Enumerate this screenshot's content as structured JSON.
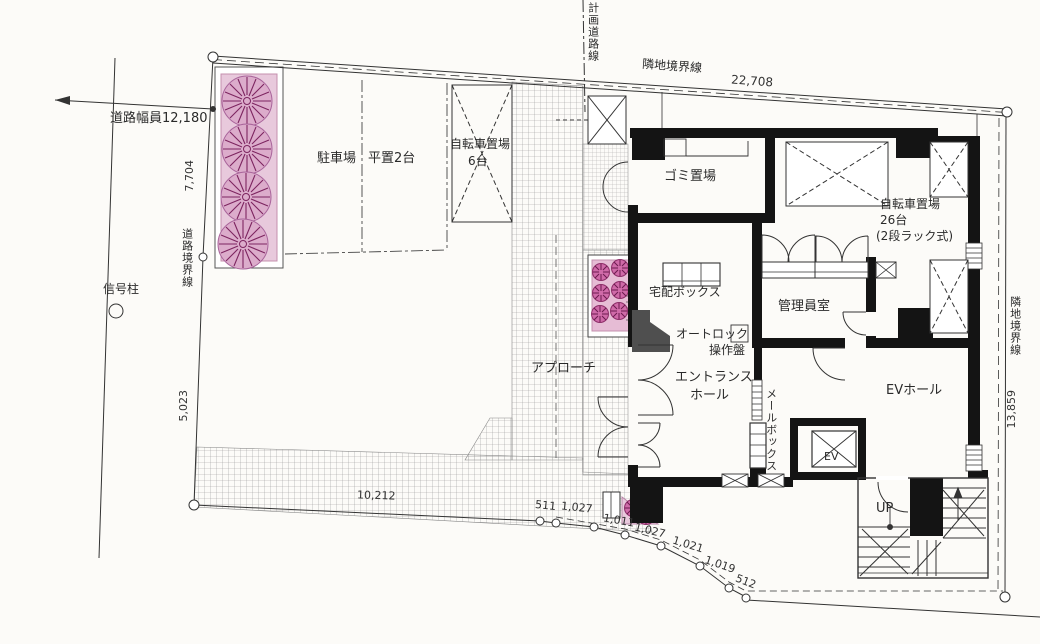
{
  "drawing": {
    "road": {
      "width_label": "道路幅員12,180",
      "signal_pole": "信号柱",
      "planned_road_line": "計画道路線",
      "road_boundary_line": "道路境界線"
    },
    "boundary": {
      "adjacent_top": "隣地境界線",
      "adjacent_right": "隣地境界線",
      "dim_top": "22,708",
      "dim_right": "13,859",
      "dim_left_upper": "7,704",
      "dim_left_lower": "5,023",
      "dim_bottom": "10,212",
      "dim_511": "511",
      "dim_1027a": "1,027",
      "dim_1011": "1,011",
      "dim_1027b": "1,027",
      "dim_1021": "1,021",
      "dim_1019": "1,019",
      "dim_512": "512"
    },
    "site": {
      "parking": "駐車場",
      "parking_type": "平置2台",
      "bicycle6": "自転車置場",
      "bicycle6_count": "6台",
      "approach": "アプローチ"
    },
    "building": {
      "garbage": "ゴミ置場",
      "bicycle26": "自転車置場",
      "bicycle26_count": "26台",
      "bicycle26_type": "(2段ラック式)",
      "delivery_box": "宅配ボックス",
      "autolock_line1": "オートロック",
      "autolock_line2": "操作盤",
      "entrance_line1": "エントランス",
      "entrance_line2": "ホール",
      "manager_room": "管理員室",
      "mailbox": "メールボックス",
      "ev_hall": "EVホール",
      "ev": "EV",
      "up": "UP"
    }
  },
  "colors": {
    "wall": "#141414",
    "planting_pink": "#e8c9dc",
    "flower_pink": "#e6bcd5",
    "tree_stroke": "#7d2560",
    "bush_fill": "#cf6aa8",
    "hatch_line": "#999999",
    "entrance_step_gray": "#4f4f4f"
  }
}
